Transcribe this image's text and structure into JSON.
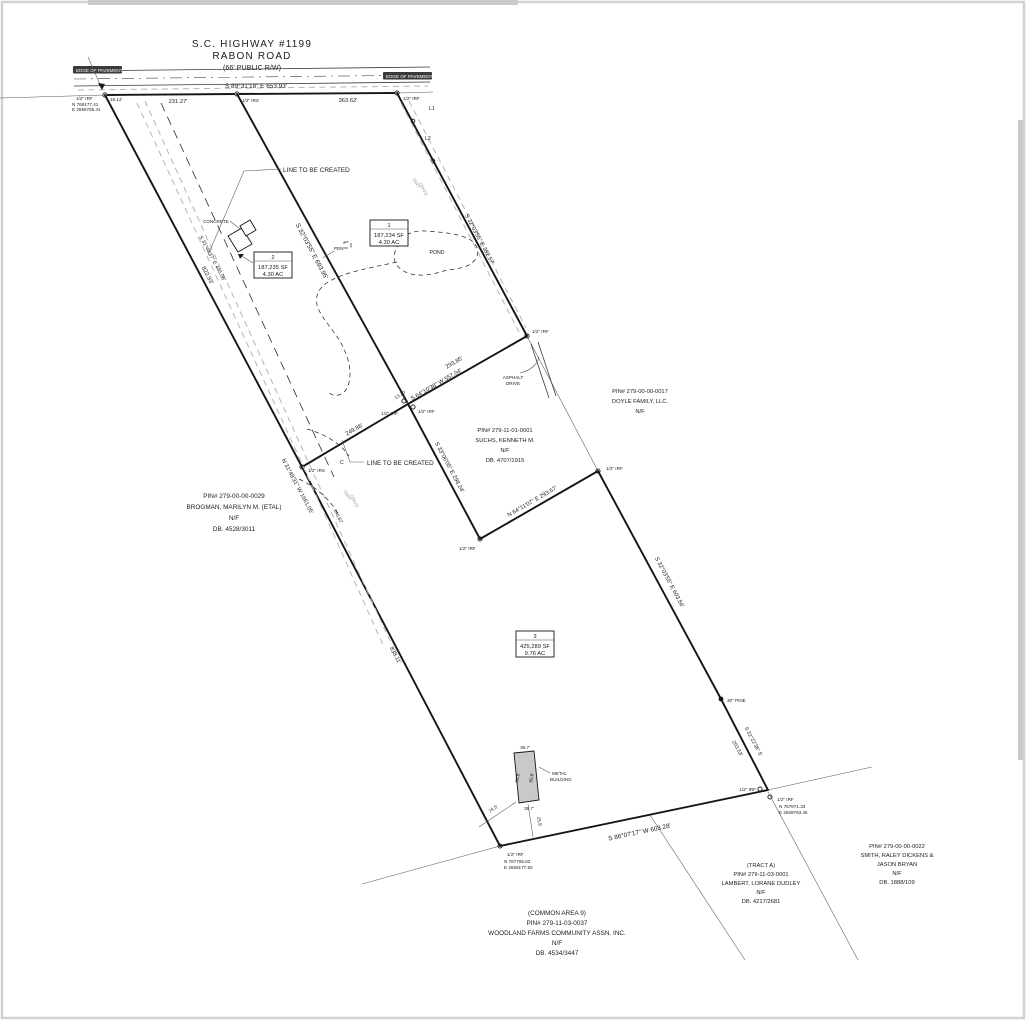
{
  "road": {
    "highway": "S.C. HIGHWAY #1199",
    "name": "RABON ROAD",
    "rw": "(66' PUBLIC R/W)",
    "edge_left": "EDGE OF PAVEMENT",
    "edge_right": "EDGE OF PAVEMENT",
    "bearing": "S 89°31'18\" E  653.93'",
    "seg1": "231.27'",
    "seg2": "363.62'"
  },
  "corners": {
    "nw_pin": "1/2\" IRF",
    "nw_n": "N 768177.41",
    "nw_e": "E 2556765.41",
    "nw_tie": "18.12'",
    "nmid_pin": "1/2\" IRS",
    "ne_pin": "1/2\" IRF",
    "l1": "L1",
    "l2": "L2",
    "asphalt_pin": "1/2\" IRF",
    "dbl_w_pin": "1/2\" IRF",
    "dbl_e_pin": "1/2\" IRF",
    "dbl_gap": "13.20'",
    "mid_irs_pin": "1/2\" IRS",
    "suchs_s_pin": "1/2\" IRF",
    "p3_ne_pin": "1/2\" IRF",
    "pine": "30\" PINE",
    "se_pin1": "1/2\" IRF",
    "se_pin2": "1/2\" IRF",
    "se_n": "N 767871.33",
    "se_e": "E 2559763.45",
    "sw_pin": "1/2\" IRF",
    "sw_n": "N 767765.82",
    "sw_e": "E 2558177.93"
  },
  "lines": {
    "created1": "LINE TO BE CREATED",
    "created2": "LINE TO BE CREATED",
    "divider12": "S 32°03'55\" E  693.95'",
    "p1_east": "S 32°03'55\" E  382.57'",
    "suchs_north_dist": "293.85'",
    "suchs_north": "S 64°10'38\" W  557.04'",
    "created2_dist": "249.86'",
    "p3_west_upper": "S 33°06'05\" E  298.24'",
    "suchs_south": "N 64°11'07\" E  293.67'",
    "p3_east": "S 32°03'55\" E  603.56'",
    "p3_se_bearing": "S 32°22'36\" E",
    "p3_se_dist": "203.53'",
    "p3_south": "S 86°07'17\" W  603.28'",
    "west_upper_dist": "822.93'",
    "west_total": "N 31°48'31\" W  1661.05'",
    "west_lower_dist": "838.11'",
    "inner_dashed": "S 31°48'37\" E  445.06'",
    "drive_dist": "246.62'",
    "curve": "C"
  },
  "parcels": {
    "p1": {
      "num": "1",
      "area_sf": "187,234 SF",
      "area_ac": "4.30 AC"
    },
    "p2": {
      "num": "2",
      "area_sf": "187,235 SF",
      "area_ac": "4.30 AC"
    },
    "p3": {
      "num": "3",
      "area_sf": "425,289 SF",
      "area_ac": "9.76 AC"
    }
  },
  "features": {
    "pond": "POND",
    "pen": "PEN",
    "concrete": "CONCRETE",
    "dirt1": "DIRT",
    "dirt2": "DRIVE",
    "asphalt1": "ASPHALT",
    "asphalt2": "DRIVE",
    "metal1": "METAL",
    "metal2": "BUILDING",
    "bldg_top": "39.7'",
    "bldg_bottom": "39.7'",
    "bldg_left": "80.8'",
    "bldg_right": "80.8'",
    "tie1": "74.5'",
    "tie2": "25.9'"
  },
  "owners": {
    "brogman": {
      "l1": "PIN# 279-00-00-0029",
      "l2": "BROGMAN, MARILYN M. (ETAL)",
      "l3": "N/F",
      "l4": "DB. 4528/3011"
    },
    "suchs": {
      "l1": "PIN# 279-11-01-0001",
      "l2": "SUCHS, KENNETH M.",
      "l3": "N/F",
      "l4": "DB. 4707/1915"
    },
    "doyle": {
      "l1": "PIN# 279-00-00-0017",
      "l2": "DOYLE FAMILY, LLC.",
      "l3": "N/F"
    },
    "common": {
      "l1": "(COMMON AREA 9)",
      "l2": "PIN# 279-11-03-0037",
      "l3": "WOODLAND FARMS COMMUNITY ASSN. INC.",
      "l4": "N/F",
      "l5": "DB. 4534/3447"
    },
    "lambert": {
      "l1": "(TRACT A)",
      "l2": "PIN# 279-11-03-0001",
      "l3": "LAMBERT, LORANE DUDLEY",
      "l4": "N/F",
      "l5": "DB. 4217/2681"
    },
    "smith": {
      "l1": "PIN# 279-00-00-0022",
      "l2": "SMITH, RALEY DICKENS &",
      "l3": "JASON BRYAN",
      "l4": "N/F",
      "l5": "DB. 1888/109"
    }
  }
}
